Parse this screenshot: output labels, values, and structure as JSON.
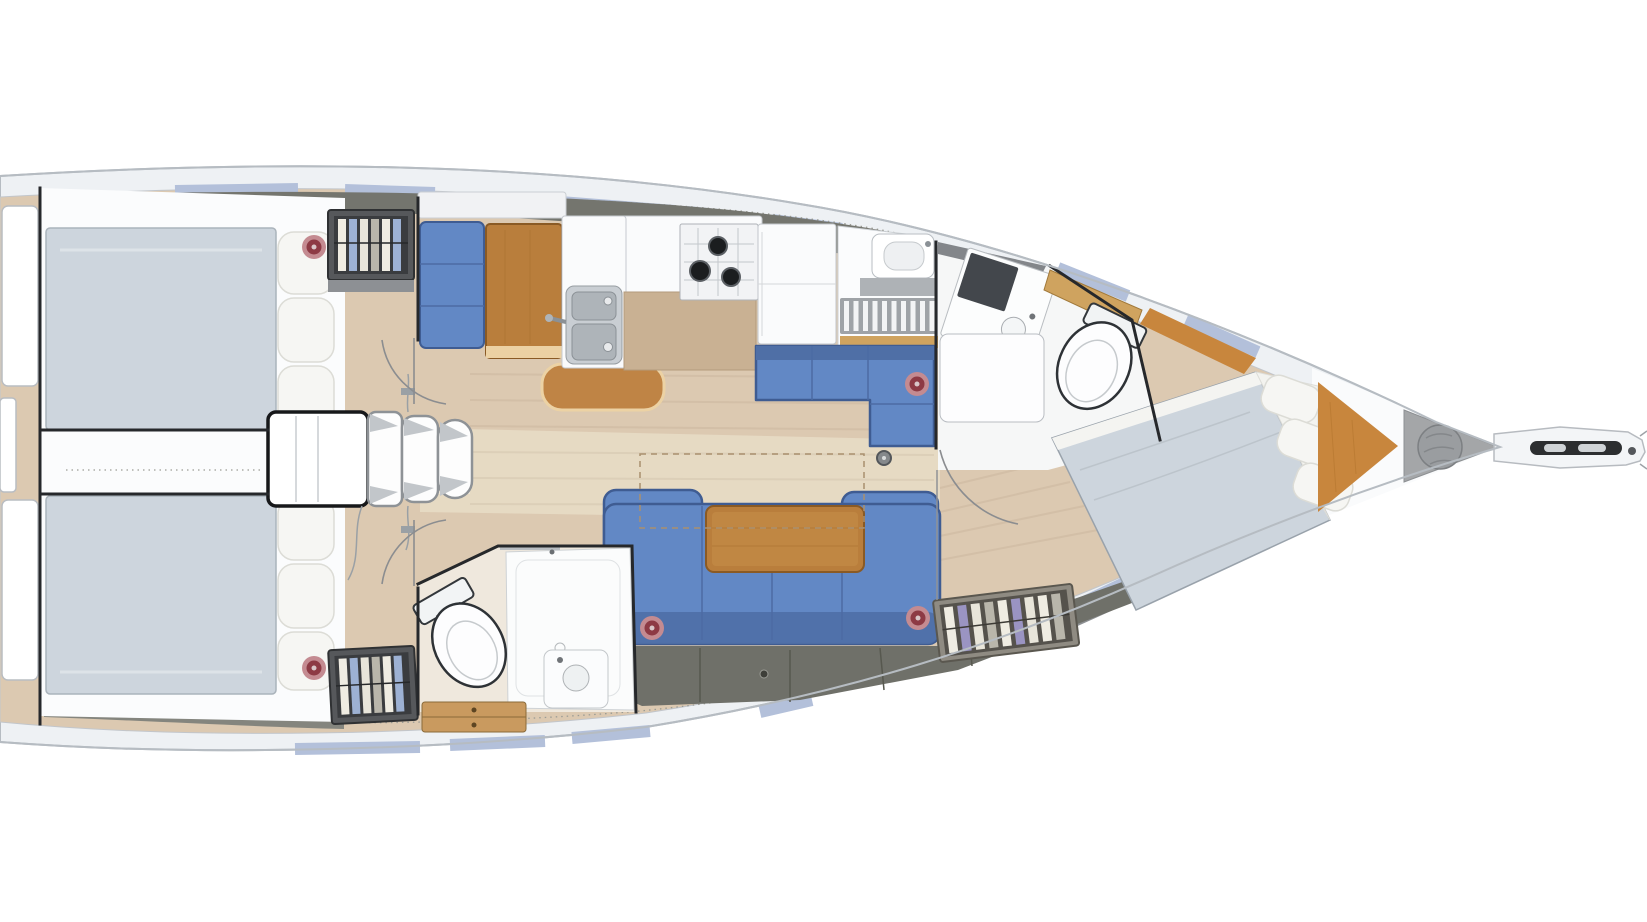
{
  "meta": {
    "diagram_type": "sailing-yacht-interior-floor-plan",
    "view": "top-down",
    "orientation": "bow-right",
    "background": "#ffffff"
  },
  "colors": {
    "deck_white": "#eef1f4",
    "hull_edge": "#b6bcc2",
    "window_blue": "#b3c0da",
    "band_dark": "#74756e",
    "band_dark_aft": "#84857e",
    "band_gray_fwd": "#8d9093",
    "floor_wood": "#dcc9b1",
    "floor_light": "#eadfc9",
    "cabin_white": "#fbfcfd",
    "bed_duvet": "#cdd5dd",
    "bed_sheet": "#f4f4f1",
    "pillow": "#f6f6f3",
    "settee_blue": "#6288c5",
    "settee_dark": "#4f6fa6",
    "settee_edge": "#3f5c92",
    "table_wood": "#b97e3c",
    "table_trim": "#ecd1a3",
    "bench_wood": "#bf8445",
    "counter_white": "#fafbfc",
    "counter_tan": "#c9b193",
    "steel": "#c9ced3",
    "basin_steel": "#aeb4b9",
    "burner_black": "#1b1d1f",
    "storage_dark": "#6f7069",
    "wall_dark": "#26282b",
    "wood_bow": "#c8863d",
    "locker_gray": "#a4a6a8",
    "bag_gray": "#9a9da0",
    "toilet_white": "#fdfdfe",
    "fixture_line": "#33373b",
    "speaker_ring": "#c48b91",
    "speaker_core": "#8d3a44",
    "speaker_dot": "#d9c6c8",
    "wardrobe_frame": "#56585b",
    "wardrobe_frame_fwd": "#8f8b82",
    "wardrobe_dark": "#3a3c3f",
    "clothes_blue": "#9db1d3",
    "clothes_purple": "#9a94c2",
    "drawer_wood": "#c99a5f",
    "shelf_wood": "#cfa35f",
    "grate_gray": "#9fa3a7",
    "arc_line": "#8b8d90",
    "dash_line": "#a98f6e"
  },
  "counts": {
    "cabins": 3,
    "heads": 2,
    "double_berths": 3,
    "speakers": 5,
    "stove_burners": 3,
    "galley_sink_basins": 2,
    "companionway_steps": 3
  },
  "areas": {
    "aft_cabin_port": {
      "name": "aft-cabin-port",
      "items": [
        "double-berth",
        "pillows",
        "hanging-locker",
        "speaker"
      ]
    },
    "aft_cabin_starboard": {
      "name": "aft-cabin-starboard",
      "items": [
        "double-berth",
        "pillows",
        "hanging-locker",
        "speaker"
      ]
    },
    "companionway": {
      "name": "companionway",
      "items": [
        "engine-box",
        "steps",
        "handrail-wires",
        "centerline"
      ]
    },
    "galley": {
      "name": "galley",
      "items": [
        "double-sink",
        "three-burner-stove",
        "worktop",
        "refrigerator"
      ]
    },
    "saloon": {
      "name": "saloon",
      "items": [
        "port-settee",
        "port-table",
        "movable-bench",
        "l-settee",
        "u-settee",
        "saloon-table",
        "speakers",
        "storage-lockers",
        "folding-table-outline",
        "mast-post"
      ]
    },
    "aft_head": {
      "name": "aft-head",
      "items": [
        "marine-toilet",
        "shower",
        "washbasin",
        "drawers"
      ]
    },
    "shower_area": {
      "name": "wet-area",
      "items": [
        "washbasin",
        "teak-grating",
        "counter"
      ]
    },
    "forward_head": {
      "name": "forward-head",
      "items": [
        "vanity-unit",
        "washbasin",
        "marine-toilet",
        "wood-shelf",
        "open-door"
      ]
    },
    "forward_cabin": {
      "name": "forward-cabin",
      "items": [
        "island-double-berth",
        "pillows",
        "hanging-locker",
        "wood-panel"
      ]
    },
    "bow": {
      "name": "bow",
      "items": [
        "sail-locker",
        "anchor-bag",
        "bowsprit",
        "anchor-roller"
      ]
    }
  }
}
